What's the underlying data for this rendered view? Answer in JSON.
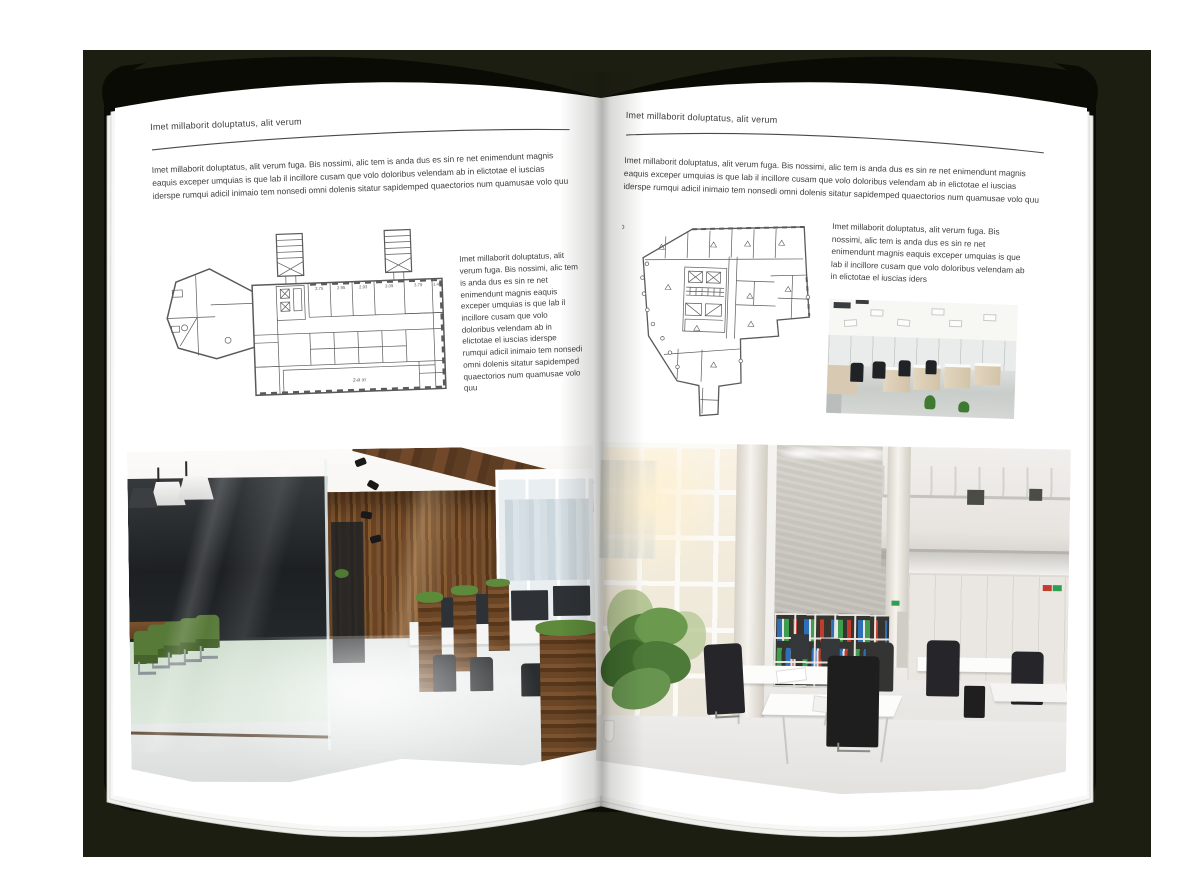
{
  "palette": {
    "backdrop": "#1d1e12",
    "cover": "#0a0b04",
    "page": "#ffffff",
    "text": "#3e3e3e",
    "plan_line": "#5a5a5a",
    "binder_blue": "#2e6fba",
    "binder_green": "#3f9e4d",
    "binder_red": "#c23b2e",
    "chair_green": "#4f6c34",
    "wood": "#6b4626"
  },
  "left_page": {
    "header": "Imet millaborit doluptatus, alit verum",
    "intro": "Imet millaborit doluptatus, alit verum fuga. Bis nossimi, alic tem is anda dus es sin re net enimendunt magnis eaquis exceper umquias is que lab il incillore cusam que volo doloribus velendam ab in elictotae el iuscias iderspe rumqui adicil inimaio tem nonsedi omni dolenis sitatur sapidemped quaectorios num quamusae volo quu",
    "side_text": "Imet millaborit doluptatus, alit verum fuga. Bis nossimi, alic tem is anda dus es sin re net enimendunt magnis eaquis exceper umquias is que lab il incillore cusam que volo doloribus velendam ab in elictotae el iuscias iderspe rumqui adicil inimaio tem nonsedi omni dolenis sitatur sapidemped quaectorios num quamusae volo quu",
    "plan_labels": [
      "2.75",
      "2.95",
      "2.93",
      "3.09",
      "3.79",
      "1.45"
    ],
    "plan_caption": "2-й эт"
  },
  "right_page": {
    "header": "Imet millaborit doluptatus, alit verum",
    "intro": "Imet millaborit doluptatus, alit verum fuga. Bis nossimi, alic tem is anda dus es sin re net enimendunt magnis eaquis exceper umquias is que lab il incillore cusam que volo doloribus velendam ab in elictotae el iuscias iderspe rumqui adicil inimaio tem nonsedi omni dolenis sitatur sapidemped quaectorios num quamusae volo quu",
    "side_text": "Imet millaborit doluptatus, alit verum fuga. Bis nossimi, alic tem is anda dus es sin re net enimendunt magnis eaquis exceper umquias is que lab il incillore cusam que volo doloribus velendam ab in elictotae el iuscias iders"
  }
}
